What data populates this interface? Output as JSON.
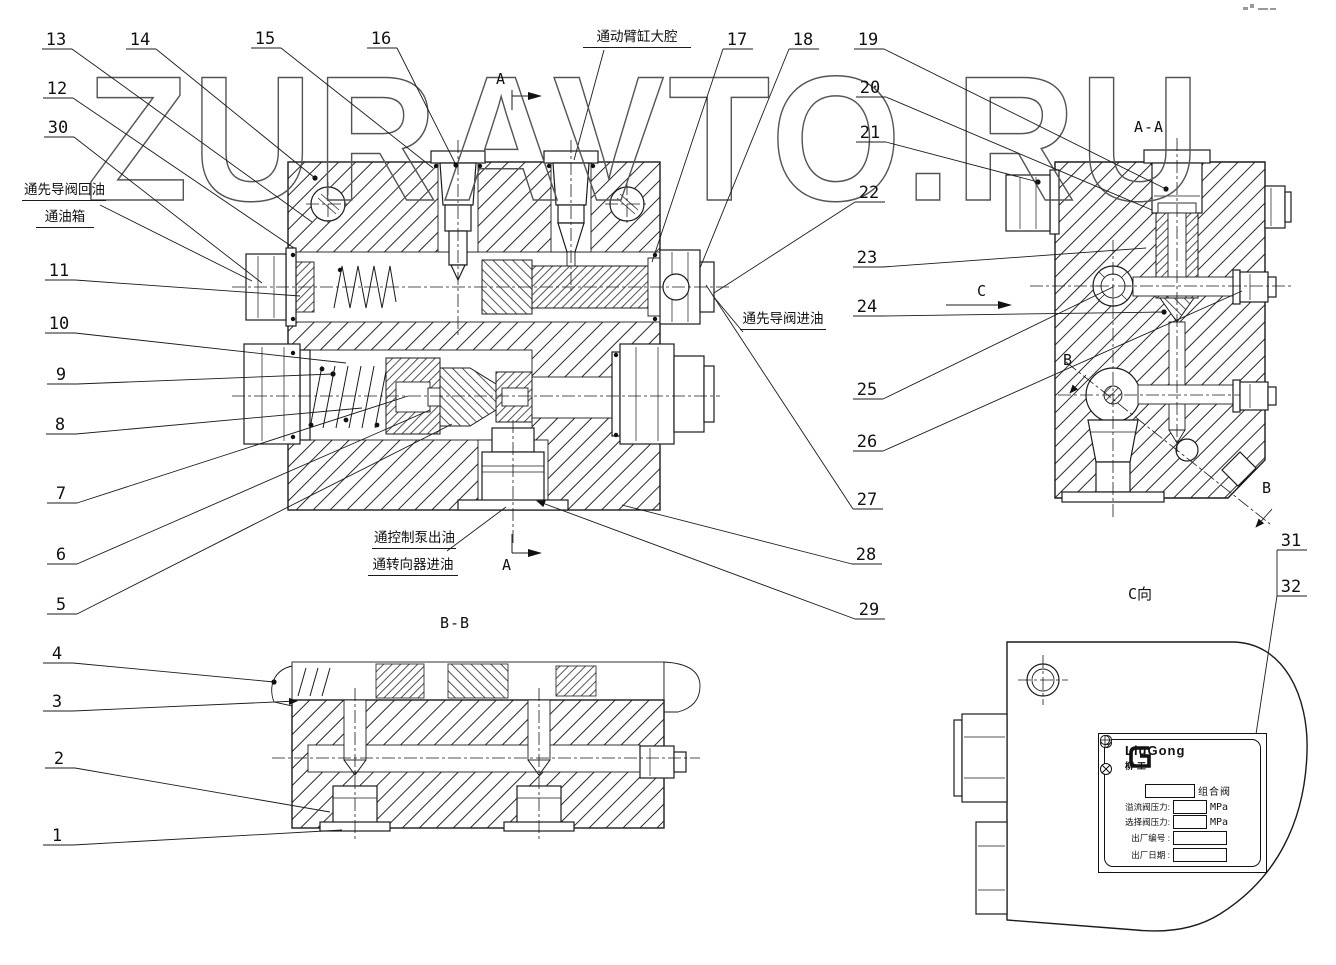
{
  "watermark": {
    "text": "ZURAVTO.RU"
  },
  "captions": {
    "bb": "B-B",
    "aa": "A-A",
    "c_view": "C向"
  },
  "markers": {
    "a_top": "A",
    "a_bottom": "A",
    "c": "C",
    "b_upper": "B",
    "b_lower": "B"
  },
  "annotations": {
    "pilot_return_1": "通先导阀回油",
    "pilot_return_2": "通油箱",
    "boom_large": "通动臂缸大腔",
    "pilot_inlet": "通先导阀进油",
    "pump_out_1": "通控制泵出油",
    "pump_out_2": "通转向器进油"
  },
  "nameplate": {
    "brand": "LiuGong",
    "brand_cn": "柳工",
    "row1": {
      "suffix": "组合阀"
    },
    "row2": {
      "label": "溢流阀压力:",
      "unit": "MPa"
    },
    "row3": {
      "label": "选择阀压力:",
      "unit": "MPa"
    },
    "row4": {
      "label": "出厂编号 :"
    },
    "row5": {
      "label": "出厂日期 :"
    }
  },
  "parts": [
    {
      "n": "1",
      "lx": 57,
      "ly": 841,
      "tx": 342,
      "ty": 830,
      "end": "none"
    },
    {
      "n": "2",
      "lx": 59,
      "ly": 764,
      "tx": 330,
      "ty": 812,
      "end": "none"
    },
    {
      "n": "3",
      "lx": 57,
      "ly": 707,
      "tx": 297,
      "ty": 701,
      "end": "arrow"
    },
    {
      "n": "4",
      "lx": 57,
      "ly": 659,
      "tx": 274,
      "ty": 682,
      "end": "dot"
    },
    {
      "n": "5",
      "lx": 61,
      "ly": 610,
      "tx": 452,
      "ty": 424,
      "end": "none"
    },
    {
      "n": "6",
      "lx": 61,
      "ly": 560,
      "tx": 430,
      "ty": 410,
      "end": "none"
    },
    {
      "n": "7",
      "lx": 61,
      "ly": 499,
      "tx": 408,
      "ty": 396,
      "end": "none"
    },
    {
      "n": "8",
      "lx": 60,
      "ly": 430,
      "tx": 362,
      "ty": 408,
      "end": "none"
    },
    {
      "n": "9",
      "lx": 61,
      "ly": 380,
      "tx": 333,
      "ty": 374,
      "end": "dot"
    },
    {
      "n": "10",
      "lx": 59,
      "ly": 329,
      "tx": 346,
      "ty": 363,
      "end": "none"
    },
    {
      "n": "11",
      "lx": 59,
      "ly": 276,
      "tx": 300,
      "ty": 296,
      "end": "none"
    },
    {
      "n": "12",
      "lx": 57,
      "ly": 94,
      "tx": 294,
      "ty": 248,
      "end": "none"
    },
    {
      "n": "13",
      "lx": 56,
      "ly": 45,
      "tx": 312,
      "ty": 222,
      "end": "none"
    },
    {
      "n": "14",
      "lx": 140,
      "ly": 45,
      "tx": 315,
      "ty": 178,
      "end": "dot"
    },
    {
      "n": "15",
      "lx": 265,
      "ly": 44,
      "tx": 433,
      "ty": 168,
      "end": "none"
    },
    {
      "n": "16",
      "lx": 381,
      "ly": 44,
      "tx": 456,
      "ty": 165,
      "end": "dot"
    },
    {
      "n": "17",
      "lx": 737,
      "ly": 45,
      "tx": 652,
      "ty": 262,
      "end": "none"
    },
    {
      "n": "18",
      "lx": 803,
      "ly": 45,
      "tx": 700,
      "ty": 268,
      "end": "none"
    },
    {
      "n": "19",
      "lx": 868,
      "ly": 45,
      "tx": 1166,
      "ty": 189,
      "end": "dot"
    },
    {
      "n": "20",
      "lx": 870,
      "ly": 93,
      "tx": 1152,
      "ty": 210,
      "end": "none"
    },
    {
      "n": "21",
      "lx": 870,
      "ly": 138,
      "tx": 1038,
      "ty": 182,
      "end": "dot"
    },
    {
      "n": "22",
      "lx": 869,
      "ly": 198,
      "tx": 714,
      "ty": 293,
      "end": "none"
    },
    {
      "n": "23",
      "lx": 867,
      "ly": 263,
      "tx": 1146,
      "ty": 248,
      "end": "none"
    },
    {
      "n": "24",
      "lx": 867,
      "ly": 312,
      "tx": 1164,
      "ty": 312,
      "end": "dot"
    },
    {
      "n": "25",
      "lx": 867,
      "ly": 395,
      "tx": 1113,
      "ty": 287,
      "end": "none"
    },
    {
      "n": "26",
      "lx": 867,
      "ly": 447,
      "tx": 1242,
      "ty": 291,
      "end": "none"
    },
    {
      "n": "27",
      "lx": 867,
      "ly": 505,
      "tx": 706,
      "ty": 285,
      "end": "none"
    },
    {
      "n": "28",
      "lx": 866,
      "ly": 560,
      "tx": 622,
      "ty": 505,
      "end": "none"
    },
    {
      "n": "29",
      "lx": 869,
      "ly": 615,
      "tx": 537,
      "ty": 501,
      "end": "arrow"
    },
    {
      "n": "30",
      "lx": 58,
      "ly": 133,
      "tx": 262,
      "ty": 283,
      "end": "none"
    },
    {
      "n": "31",
      "lx": 1291,
      "ly": 546,
      "tx": null,
      "ty": null,
      "end": "none"
    },
    {
      "n": "32",
      "lx": 1291,
      "ly": 592,
      "tx": null,
      "ty": null,
      "end": "none"
    }
  ]
}
